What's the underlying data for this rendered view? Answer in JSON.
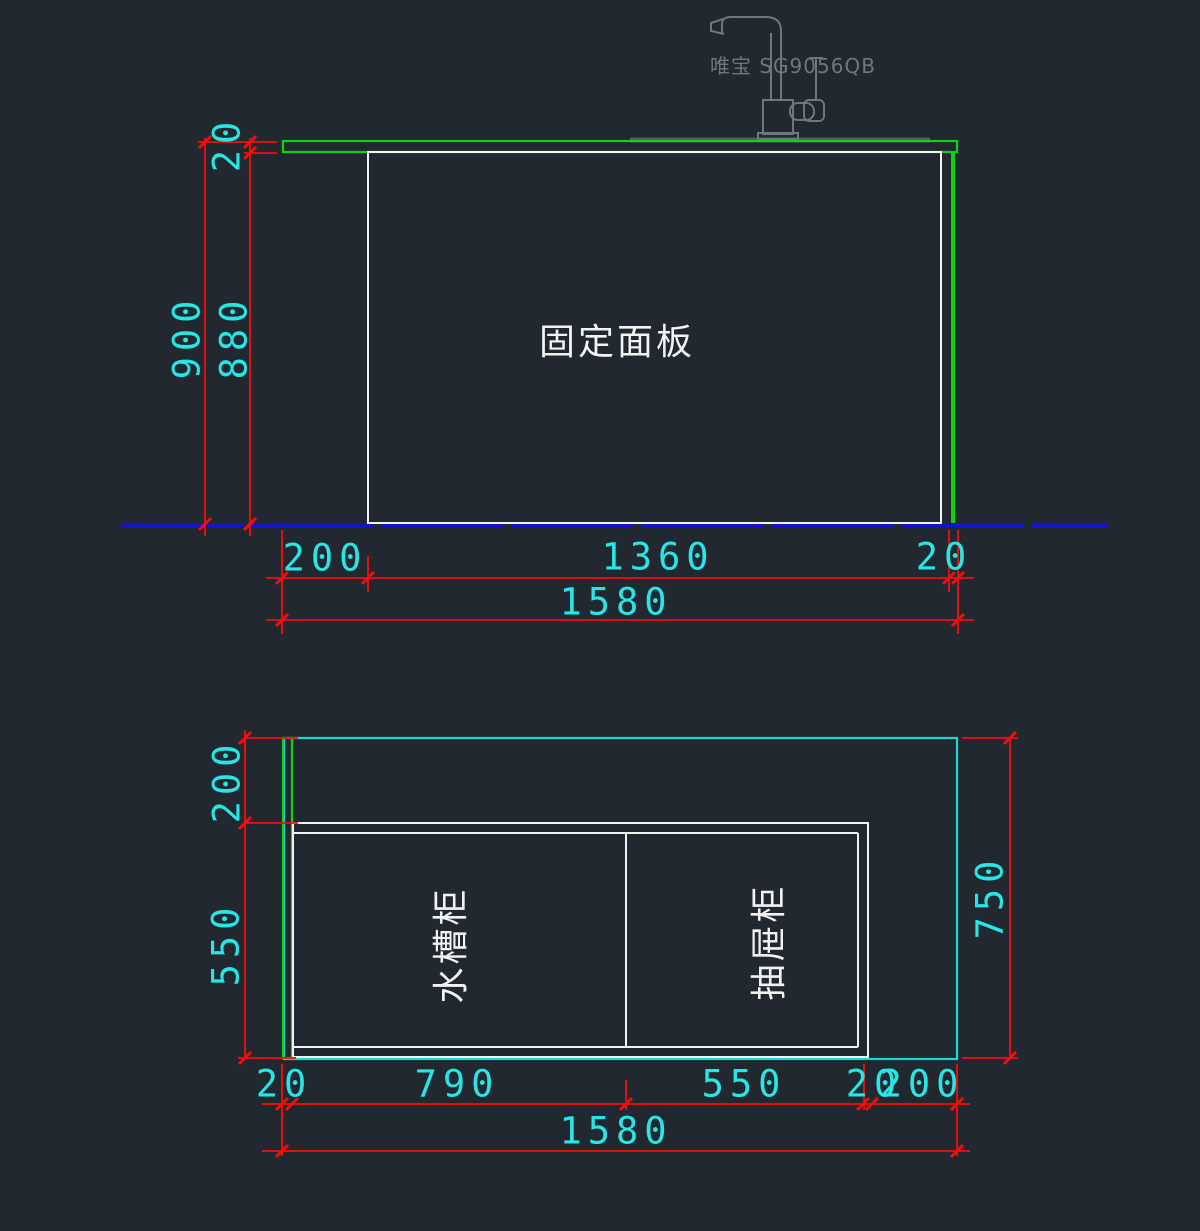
{
  "drawing": {
    "colors": {
      "background": "#222830",
      "dimension": "#f50d0d",
      "dim_text": "#27e6e6",
      "outline_white": "#f2f2f2",
      "countertop_green": "#0cd40c",
      "plan_cyan": "#1bd8d8",
      "floor_blue": "#1414cc",
      "faucet_gray": "#6f7680",
      "counter_gray": "#575d66"
    },
    "elevation": {
      "panel_label": "固定面板",
      "faucet_label": "唯宝 SG9056QB",
      "dim_total_height": "900",
      "dim_panel_height": "880",
      "dim_counter_thickness": "20",
      "dims_bottom": [
        "200",
        "1360",
        "20"
      ],
      "dim_total_width": "1580"
    },
    "plan": {
      "sink_cabinet_label": "水槽柜",
      "drawer_cabinet_label": "抽屉柜",
      "dim_left_top": "200",
      "dim_left_bottom": "550",
      "dim_right": "750",
      "dims_bottom": [
        "20",
        "790",
        "550",
        "20",
        "200"
      ],
      "dim_total_width": "1580"
    }
  }
}
